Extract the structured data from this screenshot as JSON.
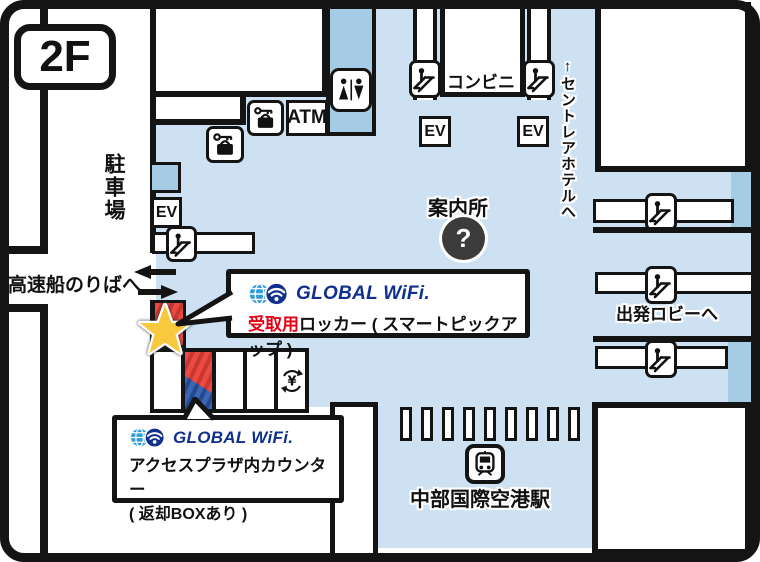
{
  "floor_badge": "2F",
  "left_area": {
    "parking_label": "駐車場",
    "boat_label": "高速船のりばへ"
  },
  "facilities": {
    "atm": "ATM",
    "ev": "EV",
    "konbini": "コンビニ",
    "info": "案内所",
    "question_mark": "?"
  },
  "right_area": {
    "hotel_label": "↑セントレアホテルへ",
    "departure_label": "出発ロビーへ"
  },
  "station": {
    "name": "中部国際空港駅",
    "gate_count": 9
  },
  "callout_pickup": {
    "brand": "GLOBAL WiFi.",
    "highlight": "受取用",
    "rest": "ロッカー ( スマートピックアップ )"
  },
  "callout_counter": {
    "brand": "GLOBAL WiFi.",
    "line1": "アクセスプラザ内カウンター",
    "line2": "( 返却BOXあり )"
  },
  "colors": {
    "floor_blue": "#cde1f2",
    "zone_blue": "#a6cbe5",
    "wall_black": "#141414",
    "brand_navy": "#10308e",
    "brand_globe_blue": "#2f9bdb",
    "highlight_red": "#e60013",
    "marker_red_stripe": "#ea4a41",
    "marker_blue_stripe": "#3a66b5",
    "star_yellow": "#f8c93e"
  }
}
